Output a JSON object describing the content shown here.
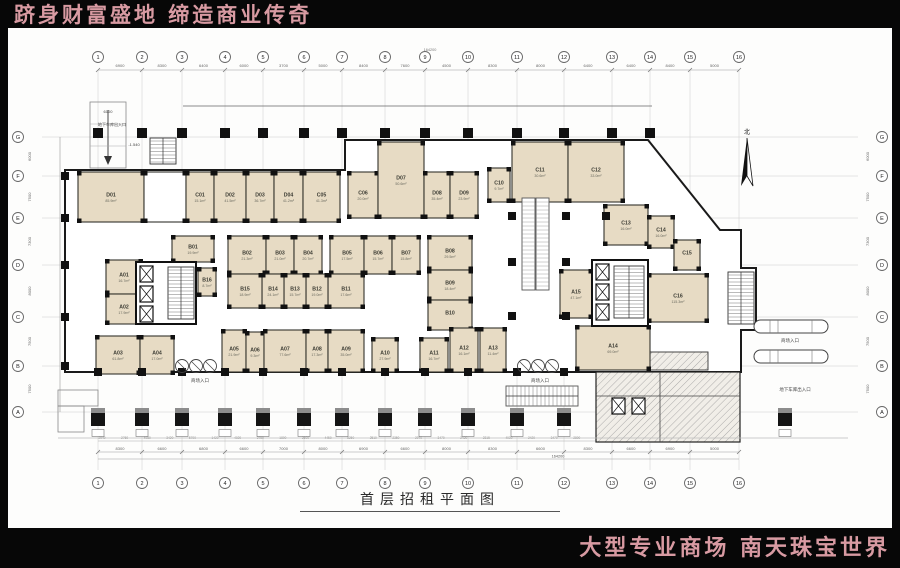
{
  "banners": {
    "top": "跻身财富盛地  缔造商业传奇",
    "bottom": "大型专业商场  南天珠宝世界"
  },
  "title": "首层招租平面图",
  "colors": {
    "banner_text": "#d89aa2",
    "room_fill": "#e7dbc4",
    "wall": "#1a1a1a",
    "grid": "#cccccc"
  },
  "plan": {
    "north_label": "北",
    "grid": {
      "cols": [
        {
          "label": "1",
          "x": 98
        },
        {
          "label": "2",
          "x": 142
        },
        {
          "label": "3",
          "x": 182
        },
        {
          "label": "4",
          "x": 225
        },
        {
          "label": "5",
          "x": 263
        },
        {
          "label": "6",
          "x": 304
        },
        {
          "label": "7",
          "x": 342
        },
        {
          "label": "8",
          "x": 385
        },
        {
          "label": "9",
          "x": 425
        },
        {
          "label": "10",
          "x": 468
        },
        {
          "label": "11",
          "x": 517
        },
        {
          "label": "12",
          "x": 564
        },
        {
          "label": "13",
          "x": 612
        },
        {
          "label": "14",
          "x": 650
        },
        {
          "label": "15",
          "x": 690
        },
        {
          "label": "16",
          "x": 739
        }
      ],
      "rows": [
        {
          "label": "G",
          "y": 137
        },
        {
          "label": "F",
          "y": 176
        },
        {
          "label": "E",
          "y": 218
        },
        {
          "label": "D",
          "y": 265
        },
        {
          "label": "C",
          "y": 317
        },
        {
          "label": "B",
          "y": 366
        },
        {
          "label": "A",
          "y": 412
        }
      ],
      "top_dims": [
        "6900",
        "8300",
        "6400",
        "6000",
        "3700",
        "5000",
        "8400",
        "7600",
        "4500",
        "8300",
        "8000",
        "6400",
        "6400",
        "8400",
        "5000"
      ],
      "bottom_dims": [
        "8300",
        "6600",
        "6800",
        "6600",
        "7000",
        "8000",
        "6900",
        "6600",
        "8000",
        "8300",
        "6600",
        "8300",
        "6600",
        "6900",
        "5000"
      ],
      "side_dims": [
        "6000",
        "7500",
        "7300",
        "8000",
        "7500",
        "7500"
      ],
      "small_dims": [
        "2940",
        "2760",
        "4080",
        "3420",
        "5700",
        "1420",
        "4020",
        "2750",
        "1800",
        "2600",
        "4450",
        "8250",
        "2510",
        "2350",
        "2970",
        "3470",
        "2420",
        "2315",
        "4030",
        "2420",
        "3470",
        "2800",
        "2980",
        "2810",
        "3070",
        "2680",
        "2410",
        "2860",
        "2140"
      ],
      "total_dim": "164200"
    },
    "rooms": [
      {
        "id": "D01",
        "area": "85.9m²",
        "x": 78,
        "y": 172,
        "w": 66,
        "h": 50
      },
      {
        "id": "",
        "area": "",
        "x": 144,
        "y": 172,
        "w": 42,
        "h": 50,
        "f": "w"
      },
      {
        "id": "C01",
        "area": "15.1m²",
        "x": 186,
        "y": 172,
        "w": 28,
        "h": 50
      },
      {
        "id": "D02",
        "area": "41.5m²",
        "x": 214,
        "y": 172,
        "w": 32,
        "h": 50
      },
      {
        "id": "D03",
        "area": "36.7m²",
        "x": 246,
        "y": 172,
        "w": 28,
        "h": 50
      },
      {
        "id": "D04",
        "area": "41.2m²",
        "x": 274,
        "y": 172,
        "w": 29,
        "h": 50
      },
      {
        "id": "C05",
        "area": "41.3m²",
        "x": 303,
        "y": 172,
        "w": 37,
        "h": 50
      },
      {
        "id": "C06",
        "area": "20.0m²",
        "x": 348,
        "y": 172,
        "w": 30,
        "h": 46
      },
      {
        "id": "D07",
        "area": "50.6m²",
        "x": 378,
        "y": 142,
        "w": 46,
        "h": 76
      },
      {
        "id": "D08",
        "area": "35.4m²",
        "x": 424,
        "y": 172,
        "w": 26,
        "h": 46
      },
      {
        "id": "D09",
        "area": "23.9m²",
        "x": 450,
        "y": 172,
        "w": 28,
        "h": 46
      },
      {
        "id": "C10",
        "area": "9.7m²",
        "x": 488,
        "y": 168,
        "w": 22,
        "h": 34
      },
      {
        "id": "C11",
        "area": "30.6m²",
        "x": 512,
        "y": 142,
        "w": 56,
        "h": 60
      },
      {
        "id": "C12",
        "area": "33.0m²",
        "x": 568,
        "y": 142,
        "w": 56,
        "h": 60
      },
      {
        "id": "C13",
        "area": "16.0m²",
        "x": 604,
        "y": 205,
        "w": 44,
        "h": 40
      },
      {
        "id": "C14",
        "area": "16.0m²",
        "x": 648,
        "y": 216,
        "w": 26,
        "h": 32
      },
      {
        "id": "C15",
        "area": "",
        "x": 674,
        "y": 240,
        "w": 26,
        "h": 30
      },
      {
        "id": "C16",
        "area": "115.3m²",
        "x": 648,
        "y": 274,
        "w": 60,
        "h": 48
      },
      {
        "id": "A15",
        "area": "47.1m²",
        "x": 560,
        "y": 270,
        "w": 32,
        "h": 48
      },
      {
        "id": "A14",
        "area": "69.0m²",
        "x": 576,
        "y": 326,
        "w": 74,
        "h": 44
      },
      {
        "id": "B01",
        "area": "19.9m²",
        "x": 172,
        "y": 236,
        "w": 42,
        "h": 26
      },
      {
        "id": "B02",
        "area": "21.3m²",
        "x": 228,
        "y": 236,
        "w": 38,
        "h": 38
      },
      {
        "id": "B03",
        "area": "21.0m²",
        "x": 266,
        "y": 236,
        "w": 28,
        "h": 38
      },
      {
        "id": "B04",
        "area": "20.7m²",
        "x": 294,
        "y": 236,
        "w": 28,
        "h": 38
      },
      {
        "id": "B05",
        "area": "17.5m²",
        "x": 330,
        "y": 236,
        "w": 34,
        "h": 38
      },
      {
        "id": "B06",
        "area": "15.7m²",
        "x": 364,
        "y": 236,
        "w": 28,
        "h": 38
      },
      {
        "id": "B07",
        "area": "15.8m²",
        "x": 392,
        "y": 236,
        "w": 28,
        "h": 38
      },
      {
        "id": "B08",
        "area": "29.5m²",
        "x": 428,
        "y": 236,
        "w": 44,
        "h": 34
      },
      {
        "id": "B09",
        "area": "18.4m²",
        "x": 428,
        "y": 270,
        "w": 44,
        "h": 30
      },
      {
        "id": "B10",
        "area": "",
        "x": 428,
        "y": 300,
        "w": 44,
        "h": 30
      },
      {
        "id": "B11",
        "area": "17.6m²",
        "x": 328,
        "y": 274,
        "w": 36,
        "h": 34
      },
      {
        "id": "B12",
        "area": "19.0m²",
        "x": 306,
        "y": 274,
        "w": 22,
        "h": 34
      },
      {
        "id": "B13",
        "area": "15.7m²",
        "x": 284,
        "y": 274,
        "w": 22,
        "h": 34
      },
      {
        "id": "B14",
        "area": "24.1m²",
        "x": 262,
        "y": 274,
        "w": 22,
        "h": 34
      },
      {
        "id": "B15",
        "area": "18.9m²",
        "x": 228,
        "y": 274,
        "w": 34,
        "h": 34
      },
      {
        "id": "B16",
        "area": "8.7m²",
        "x": 198,
        "y": 268,
        "w": 18,
        "h": 28
      },
      {
        "id": "A01",
        "area": "16.7m²",
        "x": 106,
        "y": 260,
        "w": 36,
        "h": 34
      },
      {
        "id": "A02",
        "area": "17.9m²",
        "x": 106,
        "y": 294,
        "w": 36,
        "h": 30
      },
      {
        "id": "A03",
        "area": "61.8m²",
        "x": 96,
        "y": 336,
        "w": 44,
        "h": 38
      },
      {
        "id": "A04",
        "area": "17.0m²",
        "x": 140,
        "y": 336,
        "w": 34,
        "h": 38
      },
      {
        "id": "A05",
        "area": "21.9m²",
        "x": 222,
        "y": 330,
        "w": 24,
        "h": 42
      },
      {
        "id": "A06",
        "area": "9.3m²",
        "x": 246,
        "y": 332,
        "w": 18,
        "h": 40
      },
      {
        "id": "A07",
        "area": "77.6m²",
        "x": 264,
        "y": 330,
        "w": 42,
        "h": 42
      },
      {
        "id": "A08",
        "area": "17.3m²",
        "x": 306,
        "y": 330,
        "w": 22,
        "h": 42
      },
      {
        "id": "A09",
        "area": "35.0m²",
        "x": 328,
        "y": 330,
        "w": 36,
        "h": 42
      },
      {
        "id": "A10",
        "area": "27.9m²",
        "x": 372,
        "y": 338,
        "w": 26,
        "h": 34
      },
      {
        "id": "A11",
        "area": "16.7m²",
        "x": 420,
        "y": 338,
        "w": 28,
        "h": 34
      },
      {
        "id": "A12",
        "area": "16.1m²",
        "x": 450,
        "y": 328,
        "w": 28,
        "h": 44
      },
      {
        "id": "A13",
        "area": "11.4m²",
        "x": 480,
        "y": 328,
        "w": 26,
        "h": 44
      }
    ],
    "annotations": [
      {
        "t": "地下车库出入口",
        "x": 112,
        "y": 126,
        "s": 4
      },
      {
        "t": "6100",
        "x": 108,
        "y": 113,
        "s": 4
      },
      {
        "t": "-1.540",
        "x": 134,
        "y": 146,
        "s": 4
      },
      {
        "t": "商场入口",
        "x": 200,
        "y": 382,
        "s": 4.5
      },
      {
        "t": "商场入口",
        "x": 540,
        "y": 382,
        "s": 4.5
      },
      {
        "t": "商场入口",
        "x": 790,
        "y": 342,
        "s": 4.5
      },
      {
        "t": "地下车库出入口",
        "x": 795,
        "y": 391,
        "s": 4.5
      }
    ]
  }
}
